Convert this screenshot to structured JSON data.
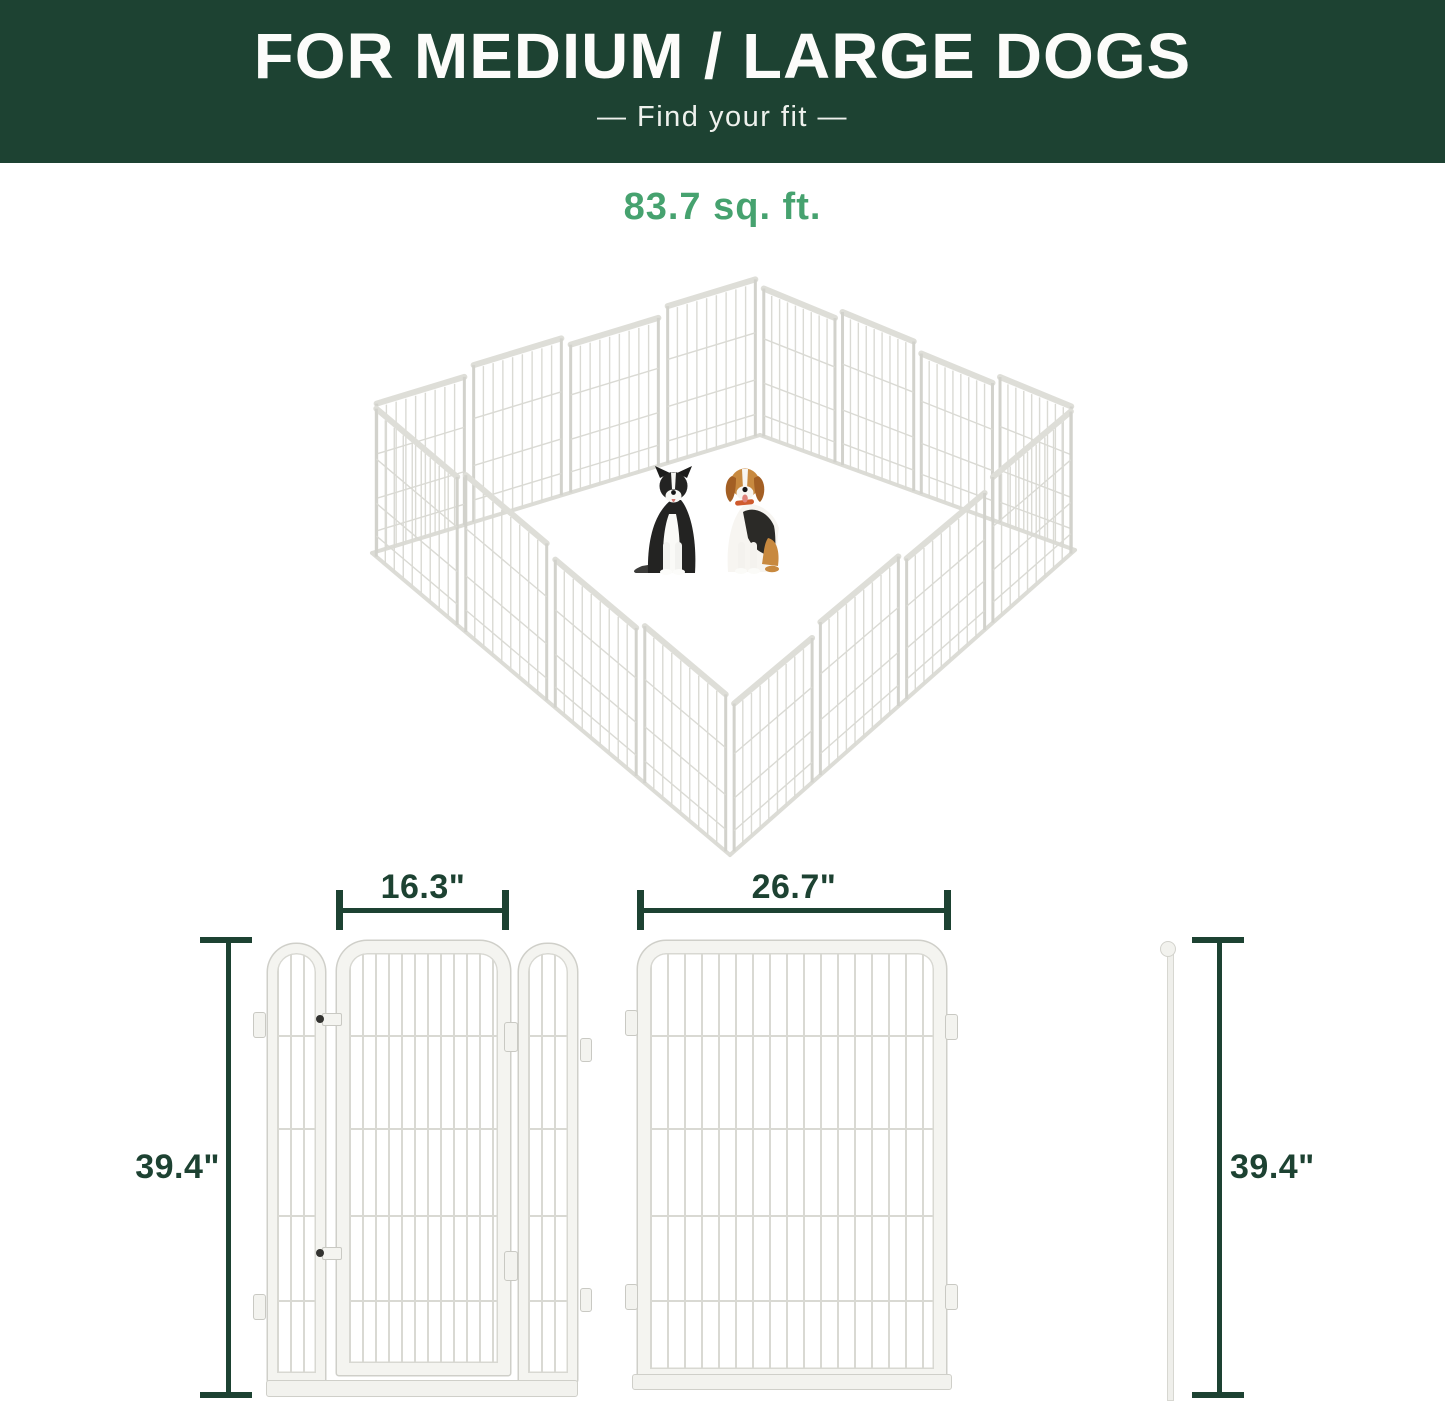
{
  "header": {
    "title": "FOR MEDIUM / LARGE DOGS",
    "subtitle": "—  Find your fit  —"
  },
  "pen": {
    "area_label": "83.7 sq. ft.",
    "dogs": [
      "border-collie",
      "beagle"
    ]
  },
  "dimensions": {
    "gate_section": {
      "width": "16.3\"",
      "height": "39.4\""
    },
    "panel_section": {
      "width": "26.7\"",
      "height": "39.4\""
    }
  },
  "colors": {
    "banner_bg": "#1d4232",
    "accent_green": "#46a26f",
    "dimension_green": "#1d4232",
    "panel_frame": "#f4f4f0",
    "panel_wire": "#d9d9d3"
  }
}
